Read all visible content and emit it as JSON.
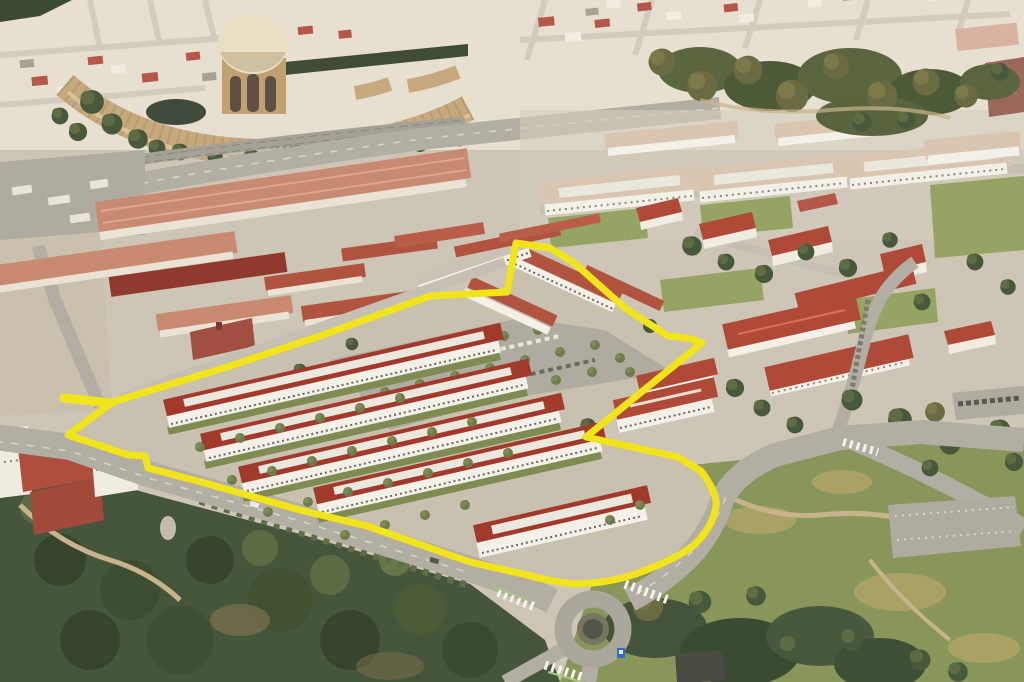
{
  "meta": {
    "kind": "aerial-3d-rendering",
    "description": "Oblique aerial rendering of the Presidio area of San Francisco; a proposed multi-building housing development site is outlined with a thick yellow boundary. No UI chrome or legible text is present in the image.",
    "width_px": 1024,
    "height_px": 682
  },
  "scene": {
    "landmarks": [
      {
        "name": "palace-of-fine-arts",
        "note": "cream dome rotunda with tan curved colonnade hall, upper left"
      },
      {
        "name": "city-blocks",
        "note": "dense cream Marina-district blocks across the top"
      },
      {
        "name": "warehouse-rows",
        "note": "long salmon- and maroon-roofed warehouses, left middle"
      },
      {
        "name": "campus-buildings",
        "note": "large white buildings with pale roofs, upper right"
      },
      {
        "name": "tree-groves",
        "note": "dark eucalyptus masses upper right, forested hillside lower left"
      },
      {
        "name": "proposed-housing-rows",
        "note": "five long white residential buildings with red hipped roofs and cream flat roof decks inside the outlined site"
      },
      {
        "name": "existing-barracks",
        "note": "red-roofed barracks along the north edge of the site"
      },
      {
        "name": "central-parking-lot",
        "note": "gray lot with rows of small trees and parked cars inside the site"
      },
      {
        "name": "corner-building",
        "note": "large red-roofed building excluded from the site by a boundary notch, east corner"
      },
      {
        "name": "roundabout",
        "note": "traffic circle with zebra crosswalks and a bus stop sign, bottom center"
      },
      {
        "name": "main-road",
        "note": "wide boulevard running along the south edge of the site"
      }
    ]
  },
  "boundary": {
    "name": "site-boundary-overlay",
    "color": "#F2E41A",
    "stroke_width": 7,
    "path_d": "M 113 402 L 68 435 L 128 455 L 145 456 L 148 468 L 205 483 L 300 510 L 367 526 L 470 562 L 527 575 Q 558 583 576 584 Q 612 583 641 572 Q 676 559 694 545 Q 713 527 716 506 Q 718 494 701 471 L 678 457 L 586 437 L 702 343 Q 690 337 668 336 L 625 308 L 573 262 L 550 248 L 516 243 L 507 292 L 430 296 L 320 336 L 230 366 Z",
    "stub_d": "M 110 403 L 64 398"
  },
  "palette": {
    "yellow_overlay": "#F2E41A",
    "new_building_roof": "#A23A2C",
    "new_building_wall": "#F3F0E8",
    "flat_roof_deck": "#EAE7DD",
    "barracks_roof_terracotta": "#B1543F",
    "bright_roof_red": "#B04A38",
    "warehouse_roof_salmon": "#C98A72",
    "maroon_roof": "#8F3A2D",
    "campus_pale_roof": "#D9C5B0",
    "road_gray": "#B3AEA3",
    "ground_tan": "#CDC6B6",
    "lawn_green": "#95A363",
    "tree_dark_green": "#48583A",
    "dome_cream": "#E9DFC5",
    "palace_tan": "#C6AA7D"
  }
}
